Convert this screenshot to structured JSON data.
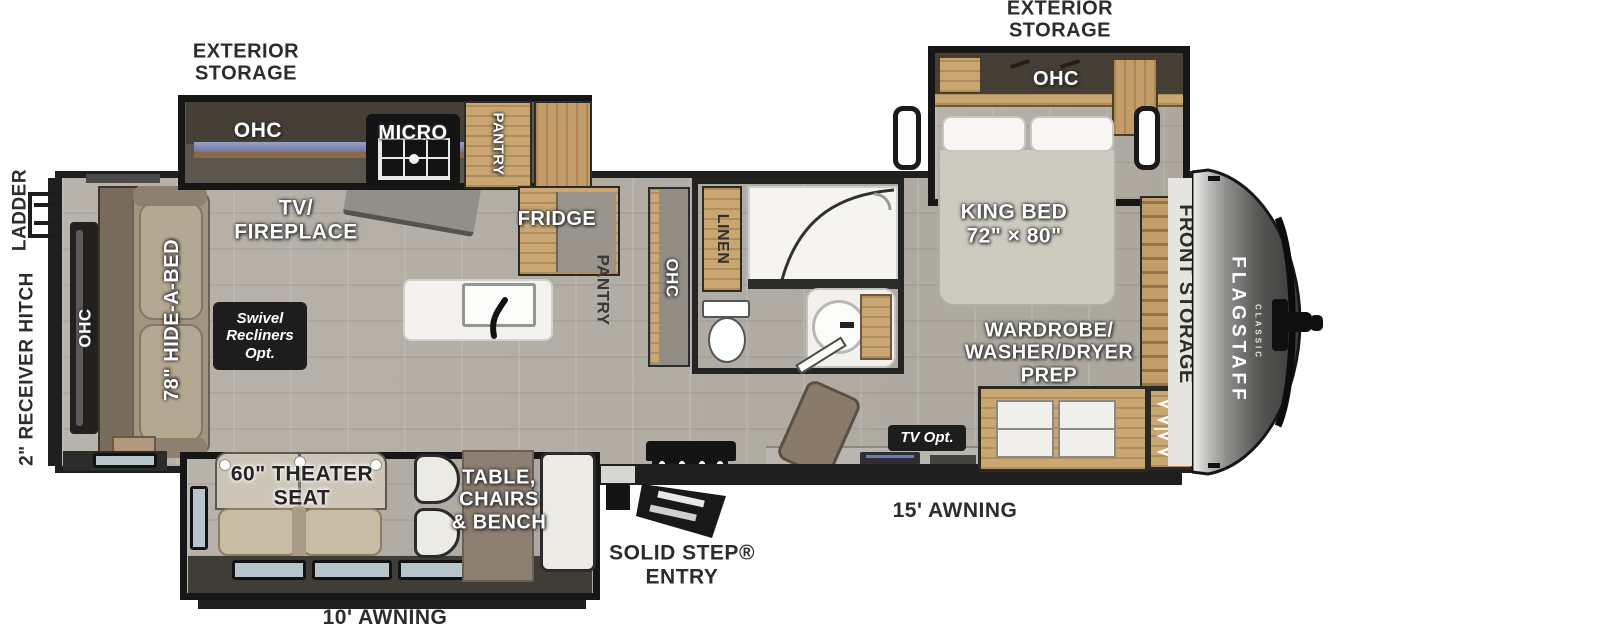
{
  "labels": {
    "exterior_storage_left": "EXTERIOR\nSTORAGE",
    "exterior_storage_right": "EXTERIOR\nSTORAGE",
    "ladder": "LADDER",
    "receiver_hitch": "2\" RECEIVER HITCH",
    "ohc_rear": "OHC",
    "hide_a_bed": "78\" HIDE-A-BED",
    "tv_fireplace": "TV/\nFIREPLACE",
    "swivel_recliners": "Swivel\nRecliners\nOpt.",
    "ohc_kitchen": "OHC",
    "micro": "MICRO",
    "pantry_kitchen": "PANTRY",
    "fridge": "FRIDGE",
    "pantry_hall": "PANTRY",
    "ohc_hall": "OHC",
    "linen": "LINEN",
    "king_bed": "KING BED\n72\" × 80\"",
    "ohc_bedroom": "OHC",
    "front_storage": "FRONT STORAGE",
    "wardrobe": "WARDROBE/\nWASHER/DRYER\nPREP",
    "tv_opt": "TV Opt.",
    "theater_seat": "60\" THEATER\nSEAT",
    "dinette": "TABLE,\nCHAIRS\n& BENCH",
    "solid_step_entry": "SOLID STEP®\nENTRY",
    "awning_15": "15' AWNING",
    "awning_10": "10' AWNING",
    "brand": "FLAGSTAFF",
    "brand_sub": "CLASSIC"
  },
  "palette": {
    "wall": "#1f1f1f",
    "floor": "#b2aea5",
    "wood": "#c9a672",
    "slide_interior": "#453f35",
    "window_glass": "#b6c4cc",
    "label_box": "#1d1d1d",
    "fixture_white": "#f3f2ef",
    "sofa": "#a79a86",
    "theater": "#c9bca5",
    "front_cap": "#3b3b39"
  }
}
